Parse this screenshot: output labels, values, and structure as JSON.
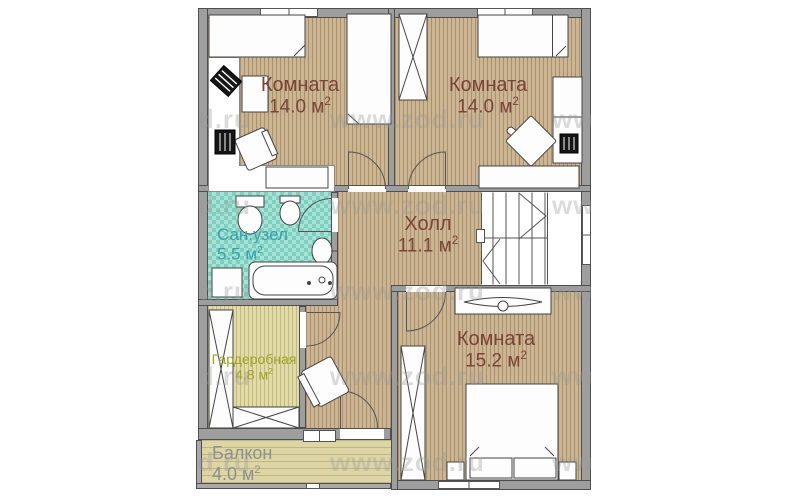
{
  "watermark": {
    "text": "www.zod.ru"
  },
  "rooms": {
    "room_tl": {
      "name": "Комната",
      "area": "14.0 м",
      "sup": "2"
    },
    "room_tr": {
      "name": "Комната",
      "area": "14.0 м",
      "sup": "2"
    },
    "bathroom": {
      "name": "Сан.узел",
      "area": "5.5 м",
      "sup": "2"
    },
    "hall": {
      "name": "Холл",
      "area": "11.1 м",
      "sup": "2"
    },
    "wardrobe": {
      "name": "Гардеробная",
      "area": "4.8 м",
      "sup": "2"
    },
    "room_br": {
      "name": "Комната",
      "area": "15.2 м",
      "sup": "2"
    },
    "balcony": {
      "name": "Балкон",
      "area": "4.0 м",
      "sup": "2"
    }
  },
  "colors": {
    "wall": "#9e9e9e",
    "wood_floor": "#cbb592",
    "bathroom_floor": "#7fcfbf",
    "wardrobe_floor": "#e2daa9",
    "balcony_floor": "#ddd5a6",
    "room_label": "#7a4537",
    "bathroom_label": "#39a1ae",
    "wardrobe_label": "#9ea428",
    "balcony_label": "#8f8f8f",
    "watermark": "#9a9a9a"
  }
}
